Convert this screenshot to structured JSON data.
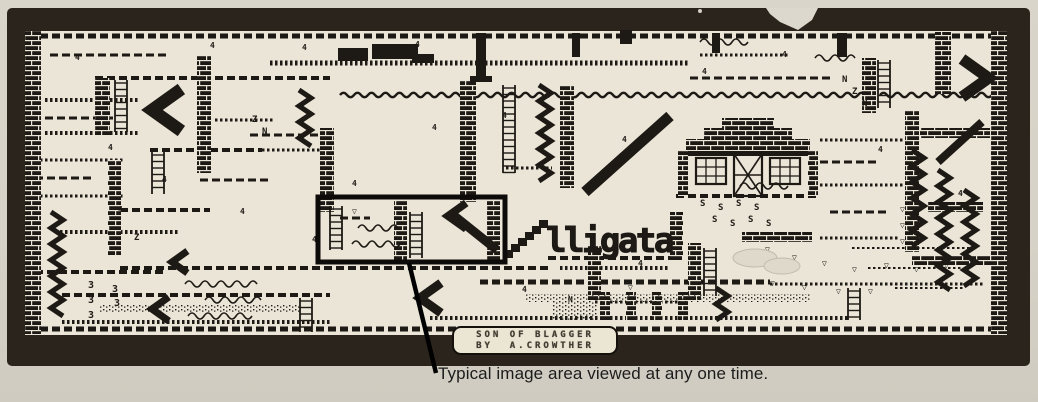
{
  "caption": {
    "text": "Typical image area viewed at any one time."
  },
  "badge": {
    "line1": "SON OF BLAGGER",
    "line2": "BY  A.CROWTHER"
  },
  "logo": {
    "text": "lligata",
    "x": 546,
    "y": 252,
    "stairs": [
      504,
      250,
      6,
      7,
      6
    ]
  },
  "colors": {
    "paper": "#d7d2c7",
    "map_bg": "#eae5d6",
    "ink": "#1d1915",
    "band": "#2a241d",
    "badge_bg": "#ebe5d4",
    "leader": "#000000"
  },
  "viewport": {
    "highlight_box": [
      318,
      197,
      187,
      65
    ],
    "leader_line": [
      409,
      263,
      436,
      373
    ]
  },
  "map": {
    "shapes": [
      [
        "plat",
        28,
        36,
        976,
        5,
        "dash"
      ],
      [
        "plat",
        28,
        329,
        976,
        5,
        "dash"
      ],
      [
        "plat",
        50,
        55,
        120,
        3,
        "dash"
      ],
      [
        "plat",
        95,
        78,
        235,
        4,
        "dash"
      ],
      [
        "plat",
        45,
        100,
        95,
        4,
        "tick"
      ],
      [
        "plat",
        45,
        118,
        70,
        3,
        "dash"
      ],
      [
        "plat",
        45,
        133,
        95,
        4,
        "tick"
      ],
      [
        "plat",
        150,
        150,
        112,
        4,
        "dash"
      ],
      [
        "plat",
        262,
        150,
        68,
        3,
        "tick"
      ],
      [
        "plat",
        270,
        63,
        420,
        5,
        "tick"
      ],
      [
        "plat",
        340,
        95,
        530,
        4,
        "wave"
      ],
      [
        "plat",
        880,
        95,
        112,
        4,
        "wave"
      ],
      [
        "plat",
        215,
        120,
        60,
        3,
        "tick"
      ],
      [
        "plat",
        250,
        135,
        80,
        3,
        "dash"
      ],
      [
        "plat",
        35,
        160,
        90,
        3,
        "tick"
      ],
      [
        "plat",
        35,
        178,
        60,
        3,
        "dash"
      ],
      [
        "plat",
        35,
        196,
        90,
        3,
        "tick"
      ],
      [
        "plat",
        120,
        210,
        90,
        4,
        "dash"
      ],
      [
        "plat",
        60,
        232,
        120,
        4,
        "tick"
      ],
      [
        "plat",
        200,
        180,
        70,
        3,
        "dash"
      ],
      [
        "plat",
        120,
        268,
        430,
        4,
        "dash"
      ],
      [
        "plat",
        560,
        268,
        110,
        4,
        "tick"
      ],
      [
        "plat",
        480,
        282,
        290,
        5,
        "dash"
      ],
      [
        "plat",
        770,
        284,
        215,
        3,
        "tick"
      ],
      [
        "plat",
        430,
        318,
        420,
        4,
        "tick"
      ],
      [
        "plat",
        62,
        295,
        268,
        4,
        "dash"
      ],
      [
        "plat",
        62,
        322,
        268,
        4,
        "tick"
      ],
      [
        "plat",
        690,
        78,
        140,
        3,
        "dash"
      ],
      [
        "plat",
        700,
        55,
        90,
        3,
        "tick"
      ],
      [
        "plat",
        820,
        140,
        85,
        3,
        "tick"
      ],
      [
        "plat",
        820,
        162,
        60,
        3,
        "dash"
      ],
      [
        "plat",
        820,
        185,
        85,
        3,
        "tick"
      ],
      [
        "plat",
        830,
        212,
        60,
        3,
        "dash"
      ],
      [
        "plat",
        820,
        238,
        80,
        3,
        "tick"
      ],
      [
        "plat",
        595,
        302,
        95,
        3,
        "tick"
      ],
      [
        "plat",
        852,
        248,
        120,
        2,
        "tick"
      ],
      [
        "plat",
        868,
        268,
        95,
        2,
        "tick"
      ],
      [
        "plat",
        895,
        288,
        70,
        2,
        "tick"
      ],
      [
        "plat",
        35,
        272,
        130,
        4,
        "dash"
      ],
      [
        "plat",
        340,
        218,
        30,
        3,
        "dash"
      ],
      [
        "plat",
        506,
        168,
        46,
        3,
        "tick"
      ],
      [
        "plat",
        548,
        258,
        130,
        4,
        "dash"
      ],
      [
        "plat",
        676,
        196,
        144,
        4,
        "dash"
      ],
      [
        "brickcol",
        25,
        31,
        16,
        303
      ],
      [
        "brickcol",
        991,
        31,
        16,
        303
      ],
      [
        "brickcol",
        95,
        78,
        15,
        58
      ],
      [
        "brickcol",
        197,
        55,
        14,
        118
      ],
      [
        "brickcol",
        320,
        128,
        14,
        84
      ],
      [
        "brickcol",
        460,
        80,
        16,
        122
      ],
      [
        "brickcol",
        560,
        85,
        14,
        103
      ],
      [
        "brickcol",
        905,
        110,
        14,
        142
      ],
      [
        "brickcol",
        862,
        58,
        14,
        55
      ],
      [
        "brickcol",
        935,
        32,
        16,
        62
      ],
      [
        "brickcol",
        108,
        160,
        13,
        95
      ],
      [
        "brickcol",
        588,
        245,
        13,
        55
      ],
      [
        "brickcol",
        688,
        243,
        13,
        57
      ],
      [
        "brickcol",
        394,
        200,
        13,
        60
      ],
      [
        "brickcol",
        487,
        200,
        13,
        60
      ],
      [
        "brickcol",
        670,
        212,
        13,
        48
      ],
      [
        "brickcol",
        600,
        292,
        10,
        28
      ],
      [
        "brickcol",
        626,
        292,
        10,
        28
      ],
      [
        "brickcol",
        652,
        292,
        10,
        28
      ],
      [
        "brickcol",
        678,
        292,
        10,
        28
      ],
      [
        "brickrow",
        920,
        128,
        70,
        10
      ],
      [
        "brickrow",
        928,
        202,
        55,
        10
      ],
      [
        "brickrow",
        912,
        256,
        82,
        10
      ],
      [
        "brickrow",
        742,
        232,
        70,
        10
      ],
      [
        "rect",
        476,
        33,
        10,
        46
      ],
      [
        "rect",
        470,
        76,
        22,
        6
      ],
      [
        "rect",
        572,
        33,
        8,
        24
      ],
      [
        "rect",
        712,
        33,
        8,
        20
      ],
      [
        "rect",
        338,
        48,
        30,
        13
      ],
      [
        "rect",
        372,
        44,
        46,
        15
      ],
      [
        "rect",
        412,
        54,
        22,
        9
      ],
      [
        "rect",
        620,
        30,
        12,
        14
      ],
      [
        "rect",
        837,
        33,
        10,
        24
      ],
      [
        "ladder",
        115,
        80,
        52
      ],
      [
        "ladder",
        152,
        152,
        42
      ],
      [
        "ladder",
        503,
        85,
        88
      ],
      [
        "ladder",
        330,
        206,
        44
      ],
      [
        "ladder",
        410,
        212,
        46
      ],
      [
        "ladder",
        878,
        60,
        48
      ],
      [
        "ladder",
        848,
        288,
        32
      ],
      [
        "ladder",
        300,
        298,
        34
      ],
      [
        "ladder",
        704,
        248,
        48
      ],
      [
        "zig",
        57,
        212,
        105
      ],
      [
        "zig",
        545,
        85,
        102
      ],
      [
        "zig",
        918,
        150,
        100
      ],
      [
        "zig",
        944,
        170,
        120
      ],
      [
        "zig",
        970,
        190,
        100
      ],
      [
        "zig",
        722,
        288,
        32
      ],
      [
        "zig",
        305,
        90,
        56
      ],
      [
        "chev",
        152,
        110,
        42,
        "l"
      ],
      [
        "chev",
        962,
        78,
        38,
        "r"
      ],
      [
        "chev",
        448,
        216,
        26,
        "l"
      ],
      [
        "chev",
        172,
        262,
        22,
        "l"
      ],
      [
        "chev",
        420,
        298,
        30,
        "l"
      ],
      [
        "chev",
        152,
        309,
        24,
        "l"
      ],
      [
        "diag",
        585,
        192,
        670,
        116,
        11
      ],
      [
        "diag",
        452,
        214,
        497,
        250,
        9
      ],
      [
        "diag",
        938,
        162,
        982,
        122,
        8
      ],
      [
        "speck",
        552,
        300,
        46,
        20
      ],
      [
        "speck",
        525,
        294,
        285,
        8
      ],
      [
        "speck",
        100,
        304,
        200,
        9
      ],
      [
        "wave",
        185,
        284,
        70
      ],
      [
        "wave",
        205,
        300,
        50
      ],
      [
        "wave",
        188,
        316,
        60
      ],
      [
        "wave",
        358,
        228,
        40
      ],
      [
        "wave",
        352,
        244,
        46
      ],
      [
        "wave",
        740,
        186,
        44
      ],
      [
        "wave",
        700,
        42,
        44
      ],
      [
        "wave",
        815,
        58,
        36
      ],
      [
        "house",
        678,
        118,
        140,
        78
      ],
      [
        "cup",
        765,
        252
      ],
      [
        "cup",
        792,
        260
      ],
      [
        "cup",
        822,
        266
      ],
      [
        "cup",
        852,
        272
      ],
      [
        "cup",
        884,
        268
      ],
      [
        "cup",
        914,
        272
      ],
      [
        "cup",
        944,
        268
      ],
      [
        "cup",
        770,
        286
      ],
      [
        "cup",
        802,
        290
      ],
      [
        "cup",
        836,
        294
      ],
      [
        "cup",
        868,
        294
      ],
      [
        "cup",
        900,
        212
      ],
      [
        "cup",
        900,
        228
      ],
      [
        "cup",
        900,
        244
      ],
      [
        "cup",
        628,
        290
      ],
      [
        "cup",
        352,
        214
      ],
      [
        "txt",
        700,
        206,
        "S",
        9
      ],
      [
        "txt",
        718,
        210,
        "S",
        9
      ],
      [
        "txt",
        736,
        206,
        "S",
        9
      ],
      [
        "txt",
        754,
        210,
        "S",
        9
      ],
      [
        "txt",
        712,
        222,
        "S",
        9
      ],
      [
        "txt",
        730,
        226,
        "S",
        9
      ],
      [
        "txt",
        748,
        222,
        "S",
        9
      ],
      [
        "txt",
        766,
        226,
        "S",
        9
      ],
      [
        "txt",
        252,
        122,
        "Z",
        9
      ],
      [
        "txt",
        262,
        134,
        "N",
        9
      ],
      [
        "txt",
        842,
        82,
        "N",
        9
      ],
      [
        "txt",
        852,
        94,
        "Z",
        9
      ],
      [
        "txt",
        862,
        106,
        "N",
        9
      ],
      [
        "txt",
        134,
        240,
        "Z",
        9
      ],
      [
        "txt",
        568,
        302,
        "N",
        8
      ],
      [
        "txt",
        88,
        288,
        "3",
        10
      ],
      [
        "txt",
        88,
        303,
        "3",
        10
      ],
      [
        "txt",
        88,
        318,
        "3",
        10
      ],
      [
        "txt",
        112,
        292,
        "3",
        10
      ],
      [
        "txt",
        114,
        306,
        "3",
        10
      ],
      [
        "txt",
        75,
        60,
        "4",
        8
      ],
      [
        "txt",
        210,
        48,
        "4",
        8
      ],
      [
        "txt",
        302,
        50,
        "4",
        8
      ],
      [
        "txt",
        415,
        47,
        "4",
        8
      ],
      [
        "txt",
        108,
        150,
        "4",
        8
      ],
      [
        "txt",
        162,
        182,
        "4",
        8
      ],
      [
        "txt",
        118,
        212,
        "4",
        8
      ],
      [
        "txt",
        240,
        214,
        "4",
        8
      ],
      [
        "txt",
        312,
        242,
        "4",
        8
      ],
      [
        "txt",
        352,
        186,
        "4",
        8
      ],
      [
        "txt",
        432,
        130,
        "4",
        8
      ],
      [
        "txt",
        502,
        118,
        "4",
        8
      ],
      [
        "txt",
        622,
        142,
        "4",
        8
      ],
      [
        "txt",
        702,
        74,
        "4",
        8
      ],
      [
        "txt",
        782,
        57,
        "4",
        8
      ],
      [
        "txt",
        878,
        152,
        "4",
        8
      ],
      [
        "txt",
        958,
        196,
        "4",
        8
      ],
      [
        "txt",
        522,
        292,
        "4",
        8
      ],
      [
        "txt",
        638,
        266,
        "4",
        8
      ],
      [
        "blob",
        755,
        258,
        22,
        9
      ],
      [
        "blob",
        782,
        266,
        18,
        8
      ]
    ]
  }
}
